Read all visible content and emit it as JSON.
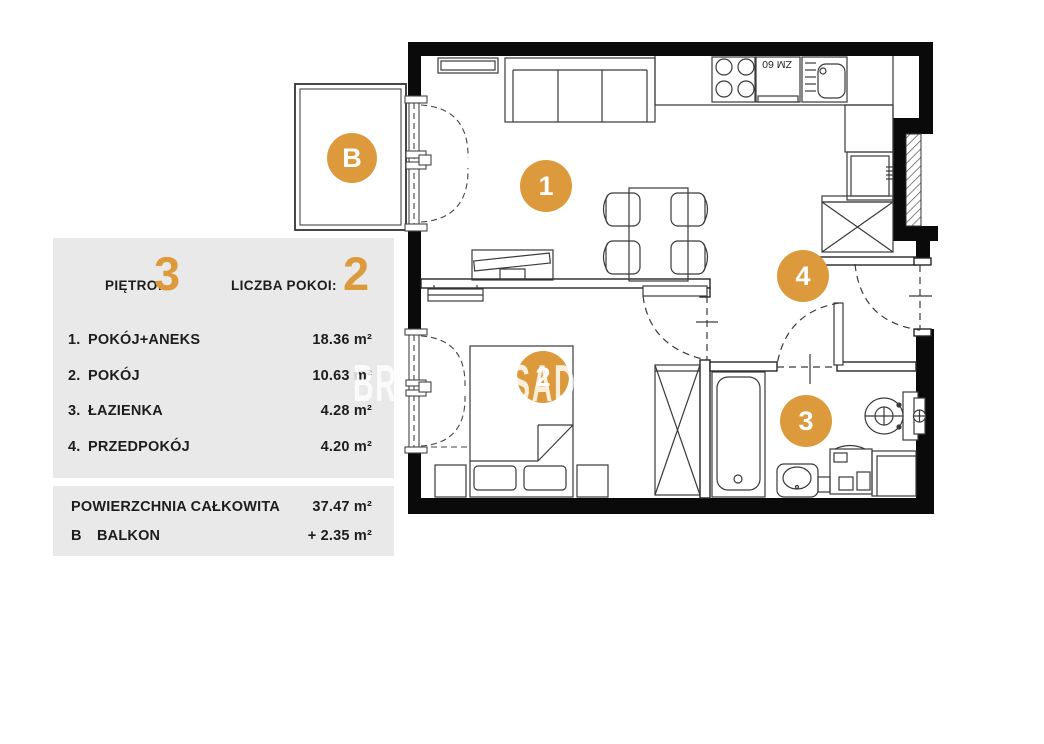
{
  "panel": {
    "header": {
      "floor_label": "PIĘTRO:",
      "floor_value": "3",
      "rooms_label": "LICZBA POKOI:",
      "rooms_value": "2"
    },
    "rooms": [
      {
        "no": "1.",
        "name": "POKÓJ+ANEKS",
        "area": "18.36 m²"
      },
      {
        "no": "2.",
        "name": "POKÓJ",
        "area": "10.63 m²"
      },
      {
        "no": "3.",
        "name": "ŁAZIENKA",
        "area": "4.28 m²"
      },
      {
        "no": "4.",
        "name": "PRZEDPOKÓJ",
        "area": "4.20 m²"
      }
    ],
    "summary": [
      {
        "no": "",
        "name": "POWIERZCHNIA CAŁKOWITA",
        "area": "37.47 m²"
      },
      {
        "no": "B",
        "name": "BALKON",
        "area": "+  2.35 m²"
      }
    ]
  },
  "plan": {
    "markers": [
      {
        "id": "balcony",
        "label": "B"
      },
      {
        "id": "room-1",
        "label": "1"
      },
      {
        "id": "room-2",
        "label": "2"
      },
      {
        "id": "room-3",
        "label": "3"
      },
      {
        "id": "room-4",
        "label": "4"
      }
    ],
    "kitchen": {
      "dishwasher_label": "ZM 60"
    },
    "watermark_fragments": [
      {
        "text": "BR"
      },
      {
        "text": "SAD"
      }
    ],
    "colors": {
      "accent": "#DC9A3C",
      "panel_bg": "#E9E9E9",
      "wall": "#0A0A0A"
    }
  }
}
